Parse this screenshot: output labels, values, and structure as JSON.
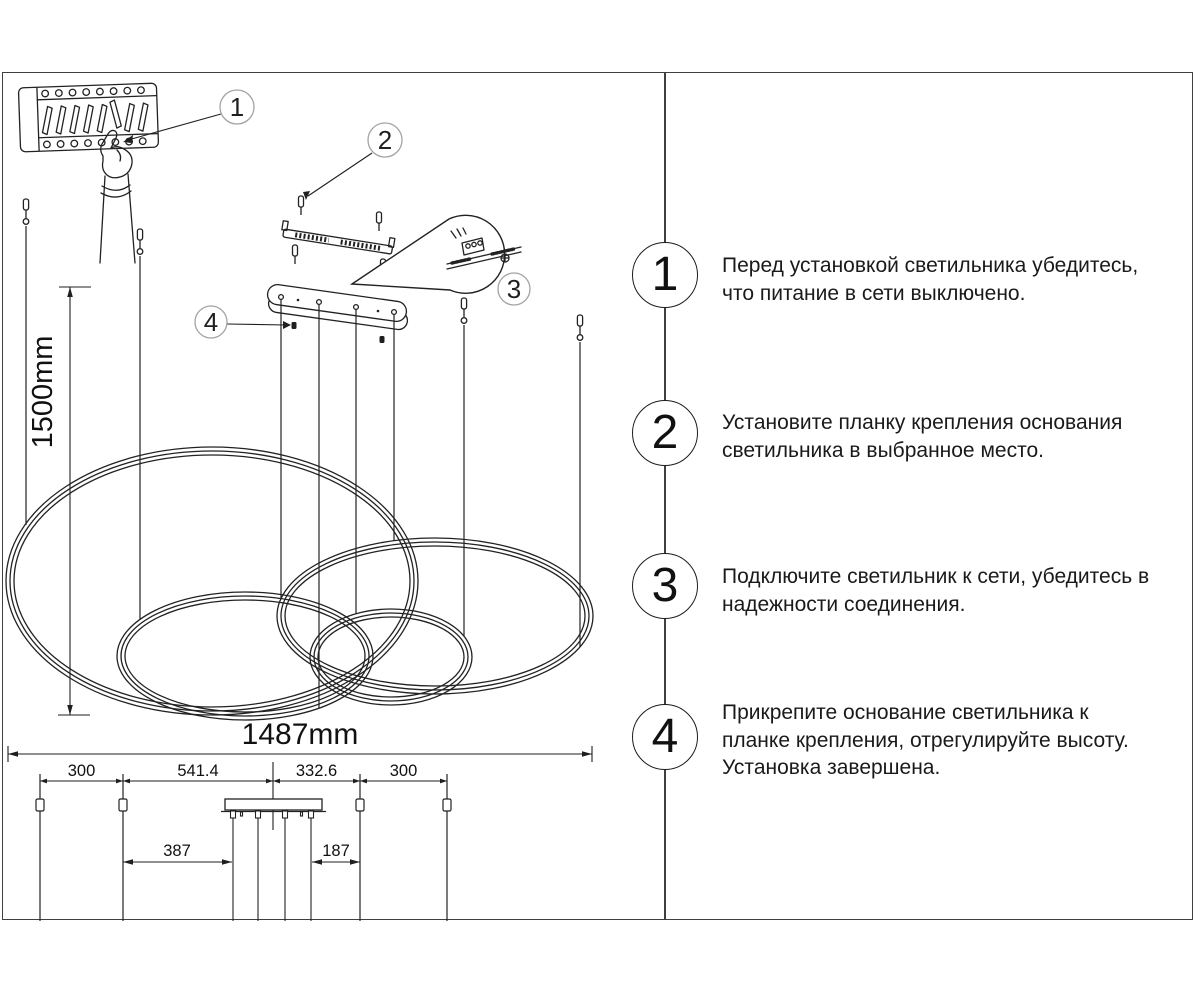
{
  "panel": {
    "steps": [
      {
        "number": "1",
        "lines": [
          "Перед установкой светильника убедитесь,",
          "что питание в сети выключено."
        ]
      },
      {
        "number": "2",
        "lines": [
          "Установите планку крепления основания",
          "светильника в выбранное место."
        ]
      },
      {
        "number": "3",
        "lines": [
          "Подключите светильник к сети, убедитесь в",
          "надежности соединения."
        ]
      },
      {
        "number": "4",
        "lines": [
          "Прикрепите основание светильника к",
          "планке крепления, отрегулируйте высоту.",
          "Установка завершена."
        ]
      }
    ]
  },
  "diagram": {
    "callouts": {
      "c1": "1",
      "c2": "2",
      "c3": "3",
      "c4": "4"
    },
    "dimensions": {
      "drop_height": "1500mm",
      "total_width": "1487mm",
      "spacing_left": "300",
      "spacing_mid_left": "541.4",
      "spacing_mid_right": "332.6",
      "spacing_right": "300",
      "offset_left": "387",
      "offset_right": "187"
    }
  },
  "colors": {
    "line": "#222222",
    "frame": "#3f3f3f",
    "callout_stroke": "#a3a3a3"
  }
}
